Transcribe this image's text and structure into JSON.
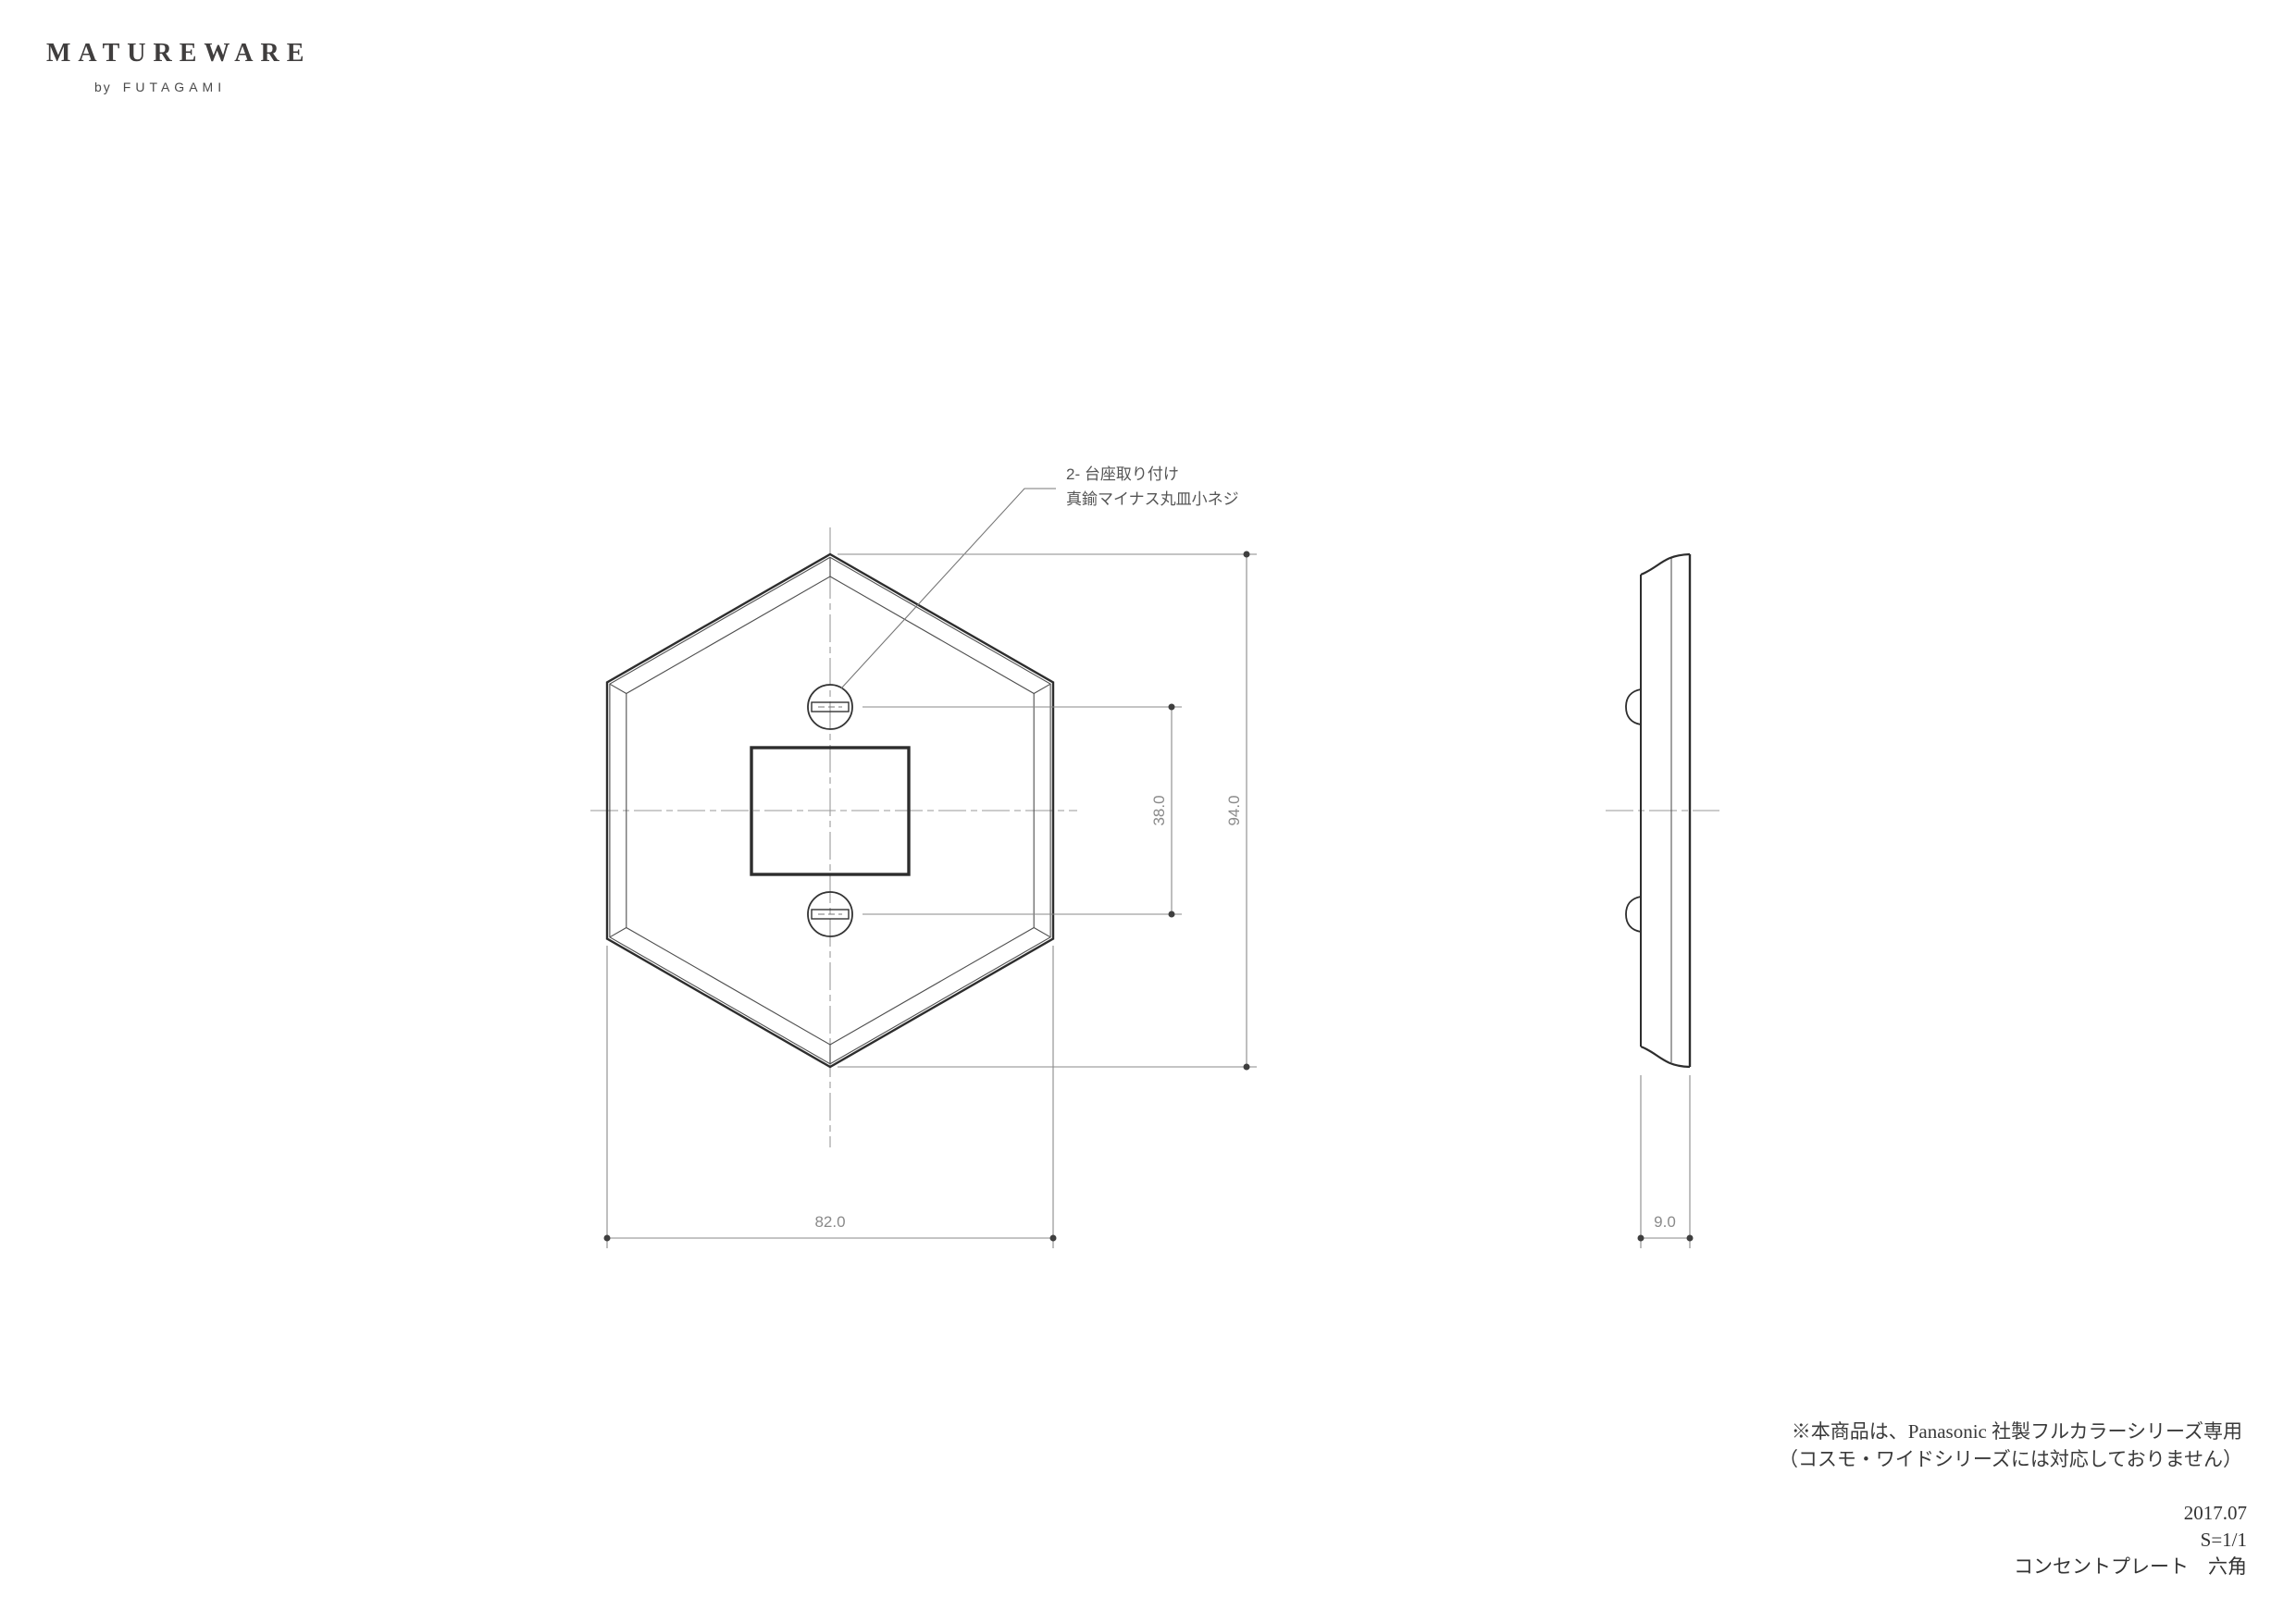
{
  "logo": {
    "brand": "MATUREWARE",
    "by": "by",
    "maker": "FUTAGAMI"
  },
  "annotation": {
    "line1": "2- 台座取り付け",
    "line2": "真鍮マイナス丸皿小ネジ"
  },
  "dimensions": {
    "screw_spacing": "38.0",
    "overall_height": "94.0",
    "overall_width": "82.0",
    "thickness": "9.0"
  },
  "notes": {
    "line1": "※本商品は、Panasonic 社製フルカラーシリーズ専用",
    "line2": "（コスモ・ワイドシリーズには対応しておりません）"
  },
  "title_block": {
    "date": "2017.07",
    "scale": "S=1/1",
    "product": "コンセントプレート　六角"
  },
  "colors": {
    "outline": "#2d2d2d",
    "thin_line": "#4f4f4f",
    "centerline": "#999999",
    "dimension_line": "#8a8a8a",
    "dimension_dot": "#3f3f3f",
    "text_gray": "#555555"
  }
}
